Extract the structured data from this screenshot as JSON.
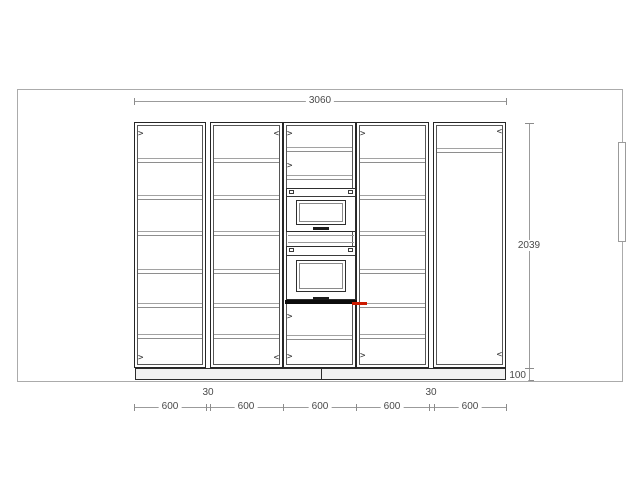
{
  "drawing": {
    "title": "kitchen-tall-unit-elevation",
    "colors": {
      "line_dark": "#262626",
      "line_medium": "#565656",
      "shelf_gray": "#9a9a9a",
      "dim_gray": "#9b9b9b",
      "room_gray": "#ababab",
      "text": "#4a4a4a",
      "marker_red": "#cc1a00"
    },
    "dims": {
      "total_width": "3060",
      "height": "2039",
      "plinth": "100",
      "bottom_600": [
        "600",
        "600",
        "600",
        "600",
        "600"
      ],
      "gaps": [
        "30",
        "30"
      ]
    },
    "geometry": {
      "room": {
        "x": 17,
        "y": 89,
        "w": 604,
        "h": 291
      },
      "window": {
        "x": 618,
        "y": 142,
        "w": 6,
        "h": 98
      },
      "top_dim": {
        "y": 101,
        "x1": 134,
        "x2": 506
      },
      "vert_dim": {
        "x": 529,
        "y1": 123,
        "y2": 380,
        "tick_ys": [
          123,
          368,
          380
        ]
      },
      "bottom_dim": {
        "y": 407,
        "x1": 134,
        "x2": 506,
        "tick_xs": [
          134,
          205.5,
          210,
          283,
          356,
          429,
          433.5,
          506
        ],
        "label600_centers": [
          170,
          246,
          320,
          392,
          470
        ],
        "label30_centers": [
          208,
          431
        ]
      },
      "cabinet_top": 122,
      "cabinet_height": 246
    },
    "cabinets": [
      {
        "name": "tall-cabinet-1",
        "x": 134,
        "w": 72,
        "shelves": [
          160,
          197,
          233,
          271,
          305,
          336
        ],
        "hinges": [
          {
            "y": 134,
            "side": "left"
          },
          {
            "y": 358,
            "side": "left"
          }
        ]
      },
      {
        "name": "tall-cabinet-2",
        "x": 210,
        "w": 73,
        "shelves": [
          160,
          197,
          233,
          271,
          305,
          336
        ],
        "hinges": [
          {
            "y": 134,
            "side": "right"
          },
          {
            "y": 358,
            "side": "right"
          }
        ]
      },
      {
        "name": "oven-housing-cabinet",
        "x": 283,
        "w": 73,
        "shelves": [
          149,
          177,
          337
        ],
        "hinges": [
          {
            "y": 134,
            "side": "left"
          },
          {
            "y": 166,
            "side": "left"
          },
          {
            "y": 317,
            "side": "left"
          },
          {
            "y": 357,
            "side": "left"
          }
        ]
      },
      {
        "name": "tall-cabinet-3",
        "x": 356,
        "w": 73,
        "shelves": [
          160,
          197,
          233,
          271,
          305,
          336
        ],
        "hinges": [
          {
            "y": 134,
            "side": "left"
          },
          {
            "y": 356,
            "side": "left"
          }
        ]
      },
      {
        "name": "tall-cabinet-4",
        "x": 433,
        "w": 73,
        "shelves": [
          150
        ],
        "hinges": [
          {
            "y": 132,
            "side": "right"
          },
          {
            "y": 355,
            "side": "right"
          }
        ]
      }
    ],
    "appliances": {
      "microwave": {
        "x": 286,
        "y": 188,
        "w": 70,
        "h": 44,
        "window": {
          "l": 9,
          "t": 11,
          "w": 50,
          "h": 25
        },
        "strip_h": 7,
        "handle_top": 38
      },
      "oven": {
        "x": 286,
        "y": 246,
        "w": 70,
        "h": 54,
        "window": {
          "l": 9,
          "t": 13,
          "w": 50,
          "h": 32
        },
        "strip_h": 8,
        "handle_top": 50
      },
      "divider_lines_y": [
        235,
        242
      ],
      "oven_base": {
        "x": 285,
        "y": 300,
        "w": 72,
        "h": 4
      }
    },
    "plinth": {
      "x": 135,
      "y": 368,
      "w": 371,
      "h": 12,
      "joint_x": 321
    },
    "marker": {
      "x": 352,
      "y": 302,
      "w": 15,
      "h": 3
    }
  }
}
